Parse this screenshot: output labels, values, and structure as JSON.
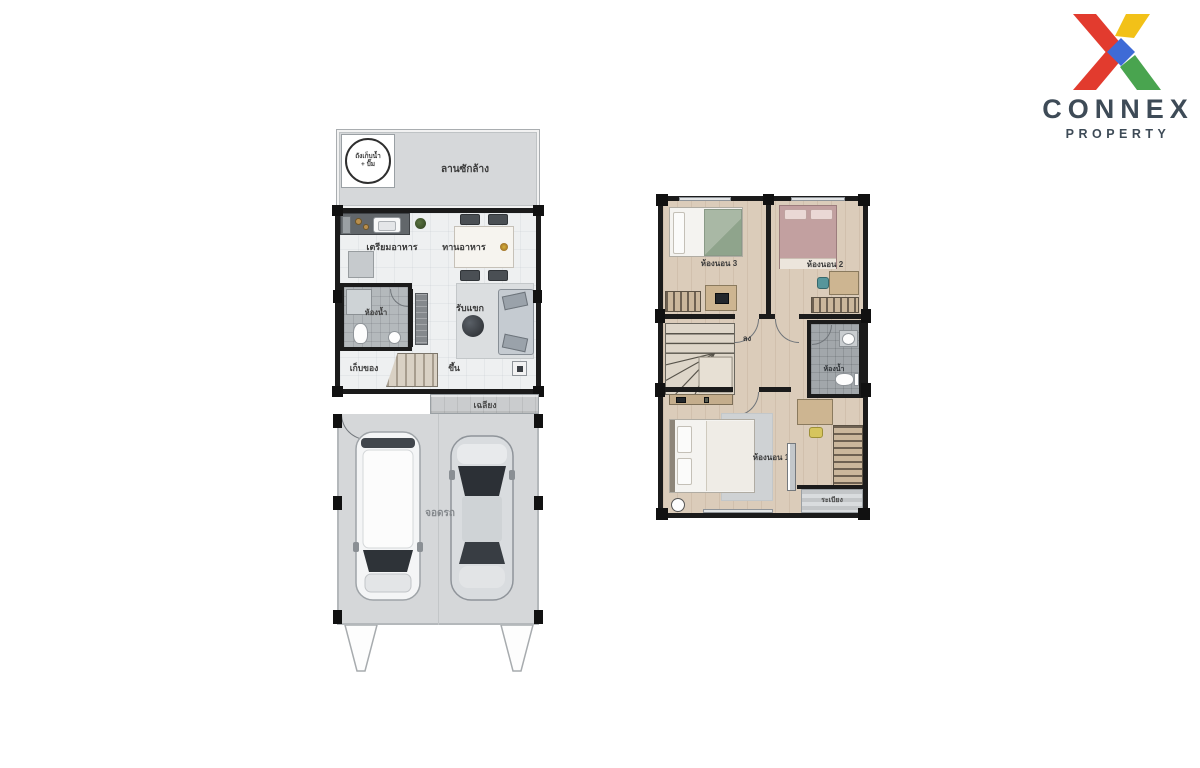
{
  "page": {
    "background": "#ffffff",
    "type": "floor-plan-sheet"
  },
  "logo": {
    "brand": "CONNEX",
    "subtitle": "PROPERTY",
    "colors": {
      "red": "#e23b2e",
      "yellow": "#f2c118",
      "green": "#49a44f",
      "blue": "#3e6bd6",
      "text": "#3e4b57"
    }
  },
  "palette": {
    "wall": "#1b1b1b",
    "ground_floor_floor": "#eef0f1",
    "yard_gray": "#d6d8da",
    "garage_gray": "#d5d7d9",
    "tile_gray": "#a2a7ab",
    "wood": "#dbccba"
  },
  "plans": {
    "ground_floor": {
      "name": "ground-floor-plan",
      "labels": {
        "tank_line1": "ถังเก็บน้ำ",
        "tank_line2": "+ ปั๊ม",
        "laundry_yard": "ลานซักล้าง",
        "kitchen_prep": "เตรียมอาหาร",
        "dining": "ทานอาหาร",
        "bathroom": "ห้องน้ำ",
        "living": "รับแขก",
        "storage": "เก็บของ",
        "stairs_up": "ขึ้น",
        "porch": "เฉลียง",
        "parking": "จอดรถ"
      }
    },
    "second_floor": {
      "name": "second-floor-plan",
      "labels": {
        "bedroom3": "ห้องนอน 3",
        "bedroom2": "ห้องนอน 2",
        "bedroom1": "ห้องนอน 1",
        "stairs_down": "ลง",
        "bathroom": "ห้องน้ำ",
        "balcony": "ระเบียง"
      }
    }
  }
}
